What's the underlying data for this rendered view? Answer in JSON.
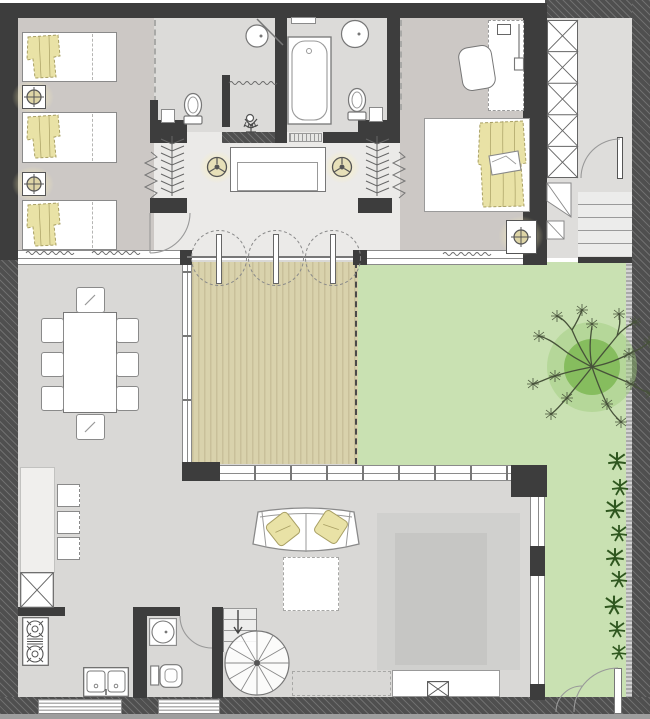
{
  "document": {
    "kind": "residential-floor-plan",
    "view": "top-down architectural plan, single storey with garden"
  },
  "rooms": [
    {
      "id": "bedroom-triple",
      "contents": [
        "single-bed",
        "single-bed",
        "single-bed",
        "nightstand-lamp",
        "nightstand-lamp",
        "wardrobe"
      ]
    },
    {
      "id": "bathroom-1",
      "contents": [
        "round-washbasin",
        "toilet",
        "shower",
        "corner-shelf"
      ]
    },
    {
      "id": "bathroom-2",
      "contents": [
        "bathtub",
        "round-washbasin",
        "toilet",
        "shelf"
      ]
    },
    {
      "id": "master-bedroom",
      "contents": [
        "double-bed",
        "desk",
        "desk-chair",
        "nightstand-lamp",
        "wardrobe"
      ]
    },
    {
      "id": "hallway",
      "contents": [
        "console-table",
        "ceiling-lamp",
        "ceiling-lamp",
        "plant",
        "triple-swing-doors"
      ]
    },
    {
      "id": "stair-hall",
      "contents": [
        "x-shelving-unit",
        "door",
        "staircase"
      ]
    },
    {
      "id": "living-dining",
      "contents": [
        "dining-table",
        "dining-chair x8",
        "kitchen-counter",
        "bar-stool x3",
        "dumbwaiter",
        "stove",
        "double-sink",
        "sofa",
        "cushion x2",
        "coffee-table",
        "rug",
        "tv-console",
        "tv",
        "sideboard",
        "spiral-staircase"
      ]
    },
    {
      "id": "wc",
      "contents": [
        "round-washbasin",
        "toilet",
        "door"
      ]
    },
    {
      "id": "deck",
      "contents": [
        "timber-boards"
      ]
    },
    {
      "id": "garden",
      "contents": [
        "lawn",
        "tree",
        "shrub x9",
        "garden-gate"
      ]
    }
  ],
  "colors": {
    "wall": "#3d3d3d",
    "wallHatch": "#4f4f4f",
    "wallEdge": "#9e9e9e",
    "floorBedroom": "#ccc8c5",
    "floorBathroom": "#dcdbd9",
    "floorHallway": "#ebeae8",
    "floorStairhall": "#dedddb",
    "floorLiving": "#d9d8d6",
    "counter": "#f0efed",
    "deckLight": "#d9d2ac",
    "deckDark": "#c9c09a",
    "lawn": "#c9e1b2",
    "lawnShade": "#9ecb79",
    "treeCore": "#7eb854",
    "treeBranch": "#47523a",
    "plant": "#2f571f",
    "blanket": "#e9e2a6",
    "blanketStroke": "#a89f63",
    "stroke": "#8a8a8a",
    "strokeDark": "#555555",
    "glass": "#8a8a8a",
    "rugOuter": "#d0d0ce",
    "rugInner": "#c6c6c4",
    "glow": "rgba(252,241,180,0.92)",
    "arc": "#999999"
  }
}
